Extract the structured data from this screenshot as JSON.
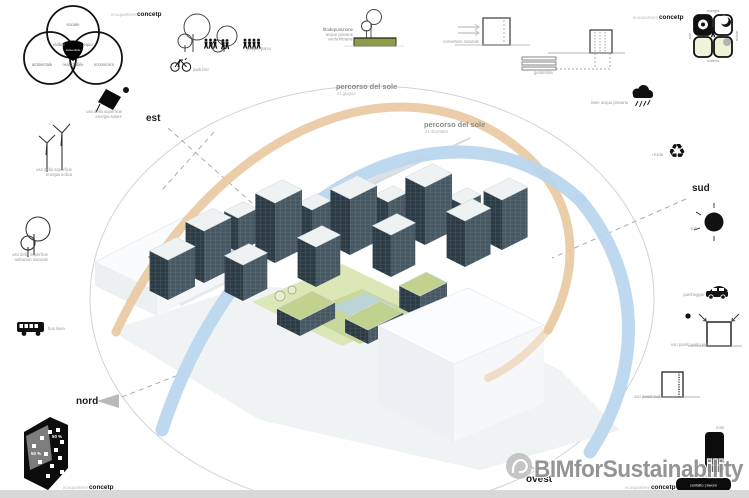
{
  "concept_label": {
    "prefix": "ecoquartiere",
    "word": "concetp"
  },
  "venn": {
    "top": "sociale",
    "left": "ambientale",
    "right": "economico",
    "overlap_left": "vivibile",
    "overlap_right": "equo",
    "overlap_bottom": "realizzabile",
    "center": "sostenibile"
  },
  "compass": {
    "est": "est",
    "sud": "sud",
    "nord": "nord",
    "ovest": "ovest"
  },
  "sun_paths": {
    "summer": {
      "title": "percorso del sole",
      "date": "21 giugno",
      "color": "#e9c9a0"
    },
    "winter": {
      "title": "percorso del sole",
      "date": "21 dicembre",
      "color": "#b9d6ee"
    }
  },
  "top_icons": {
    "park": {
      "label": "people parco"
    },
    "bike": {
      "label": "park bici"
    },
    "fito": {
      "title": "fitodepurazione",
      "line2": "acque piovane",
      "line3": "verde filtrante"
    },
    "convettore": {
      "label": "convettore naturale"
    },
    "geotermia": {
      "label": "geotermia"
    }
  },
  "left_icons": {
    "solar": {
      "line1": "uso della superficie",
      "line2": "energia solare"
    },
    "wind": {
      "line1": "uso della superficie",
      "line2": "energia eolica"
    },
    "tree": {
      "line1": "uso della superficie",
      "line2": "ambiente naturale"
    },
    "bus": {
      "label": "bus linea"
    }
  },
  "right_icons": {
    "rain": {
      "label": "linee acqua piovana"
    },
    "recycle": {
      "label": "ricicla",
      "glyph": "♻"
    },
    "sun": {
      "label": "sole"
    },
    "parking": {
      "label": "parcheggio"
    },
    "walls_est": {
      "label": "uso pareti vento est"
    },
    "walls_sud": {
      "label": "uso pareti sud"
    }
  },
  "matrix": {
    "top": "energia",
    "bottom": "materia",
    "left": "sole",
    "right": "acqua"
  },
  "site_plan": {
    "pct_gray": "50 %",
    "pct_black": "50 %"
  },
  "legend": {
    "note": "note",
    "home": "casa",
    "between": "tempo libero",
    "services": "contatto | lavoro"
  },
  "watermark": {
    "text": "BIMforSustainability"
  }
}
